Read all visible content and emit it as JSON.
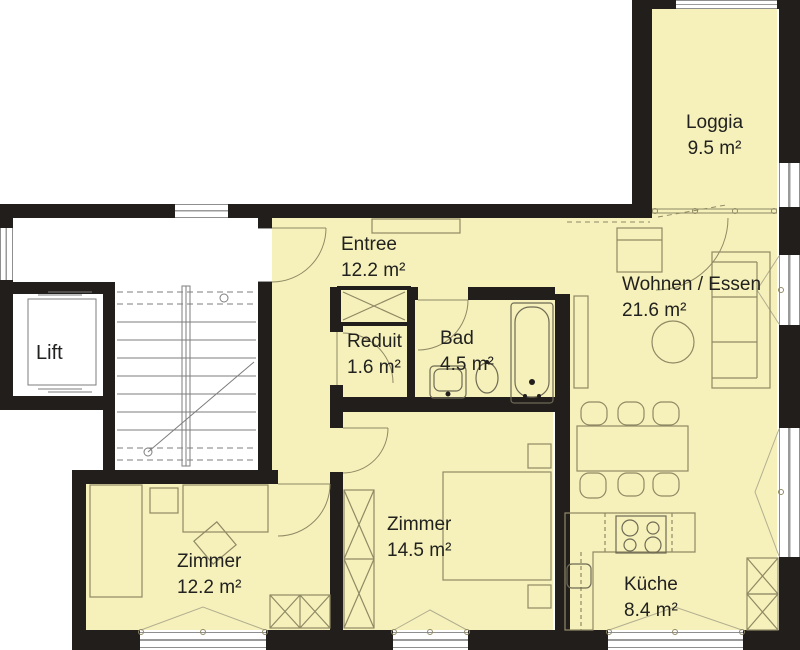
{
  "colors": {
    "room_fill": "#f6f1ba",
    "wall": "#211e1c",
    "furniture_line": "#8f8965",
    "common_line": "#7d7d7d",
    "text": "#21211f"
  },
  "rooms": {
    "loggia": {
      "name": "Loggia",
      "area": "9.5 m²"
    },
    "entree": {
      "name": "Entree",
      "area": "12.2 m²"
    },
    "wohnen_essen": {
      "name": "Wohnen / Essen",
      "area": "21.6 m²"
    },
    "lift": {
      "name": "Lift",
      "area": ""
    },
    "reduit": {
      "name": "Reduit",
      "area": "1.6 m²"
    },
    "bad": {
      "name": "Bad",
      "area": "4.5 m²"
    },
    "zimmer_1": {
      "name": "Zimmer",
      "area": "14.5 m²"
    },
    "zimmer_2": {
      "name": "Zimmer",
      "area": "12.2 m²"
    },
    "kueche": {
      "name": "Küche",
      "area": "8.4 m²"
    }
  }
}
